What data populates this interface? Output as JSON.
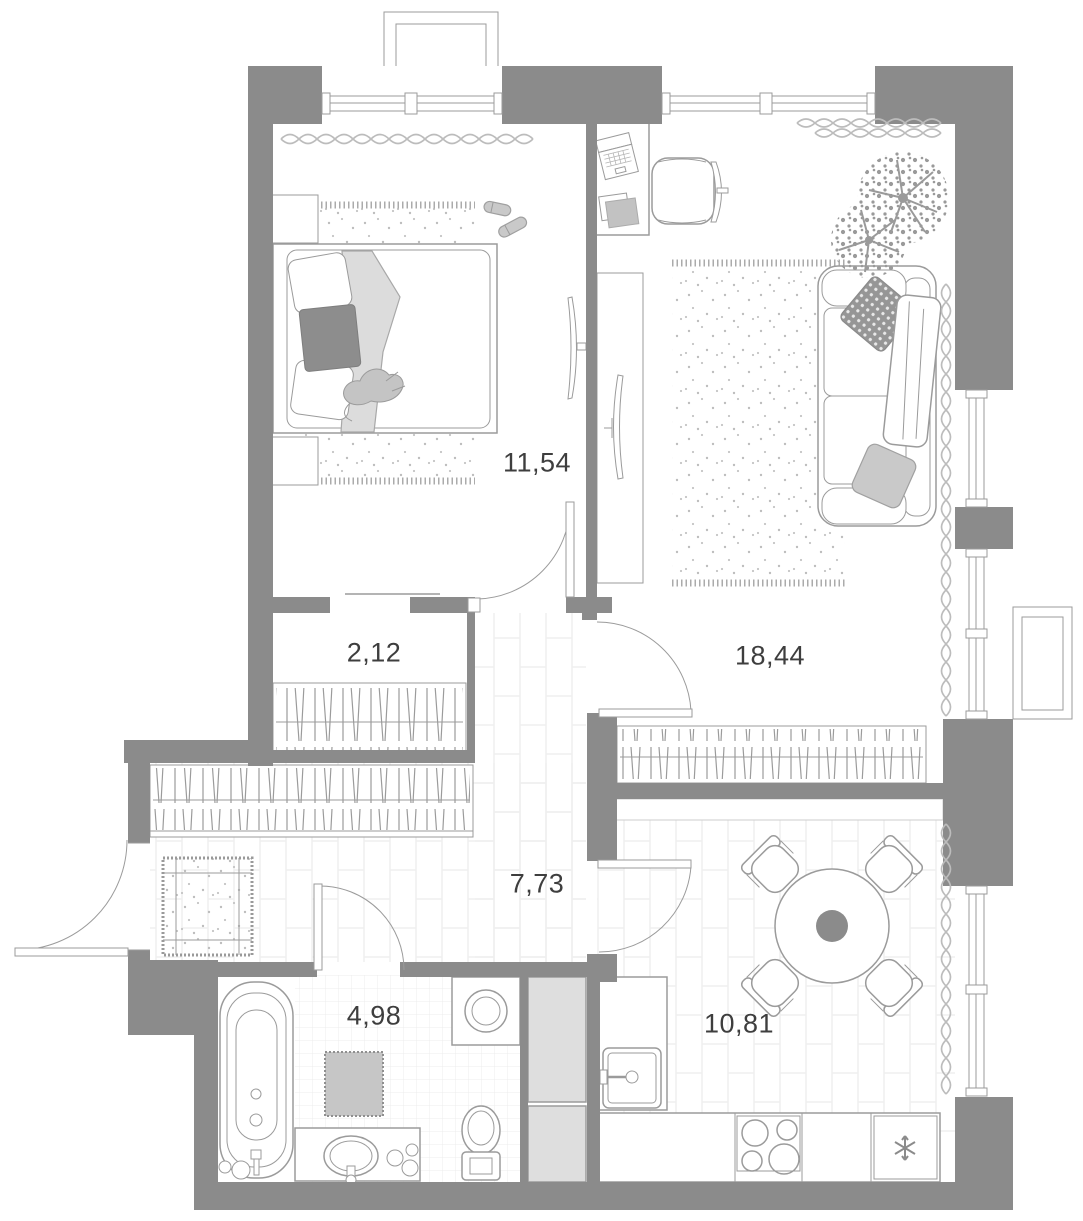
{
  "plan": {
    "type": "apartment-floor-plan",
    "wall_color": "#8b8b8b",
    "line_color": "#9b9b9b",
    "label_color": "#3e3e3e",
    "rooms": [
      {
        "id": "bedroom",
        "area": "11,54"
      },
      {
        "id": "closet",
        "area": "2,12"
      },
      {
        "id": "living-room",
        "area": "18,44"
      },
      {
        "id": "hallway",
        "area": "7,73"
      },
      {
        "id": "bathroom",
        "area": "4,98"
      },
      {
        "id": "kitchen",
        "area": "10,81"
      }
    ],
    "icons": {
      "fridge_icon": "snowflake-asterisk"
    }
  }
}
